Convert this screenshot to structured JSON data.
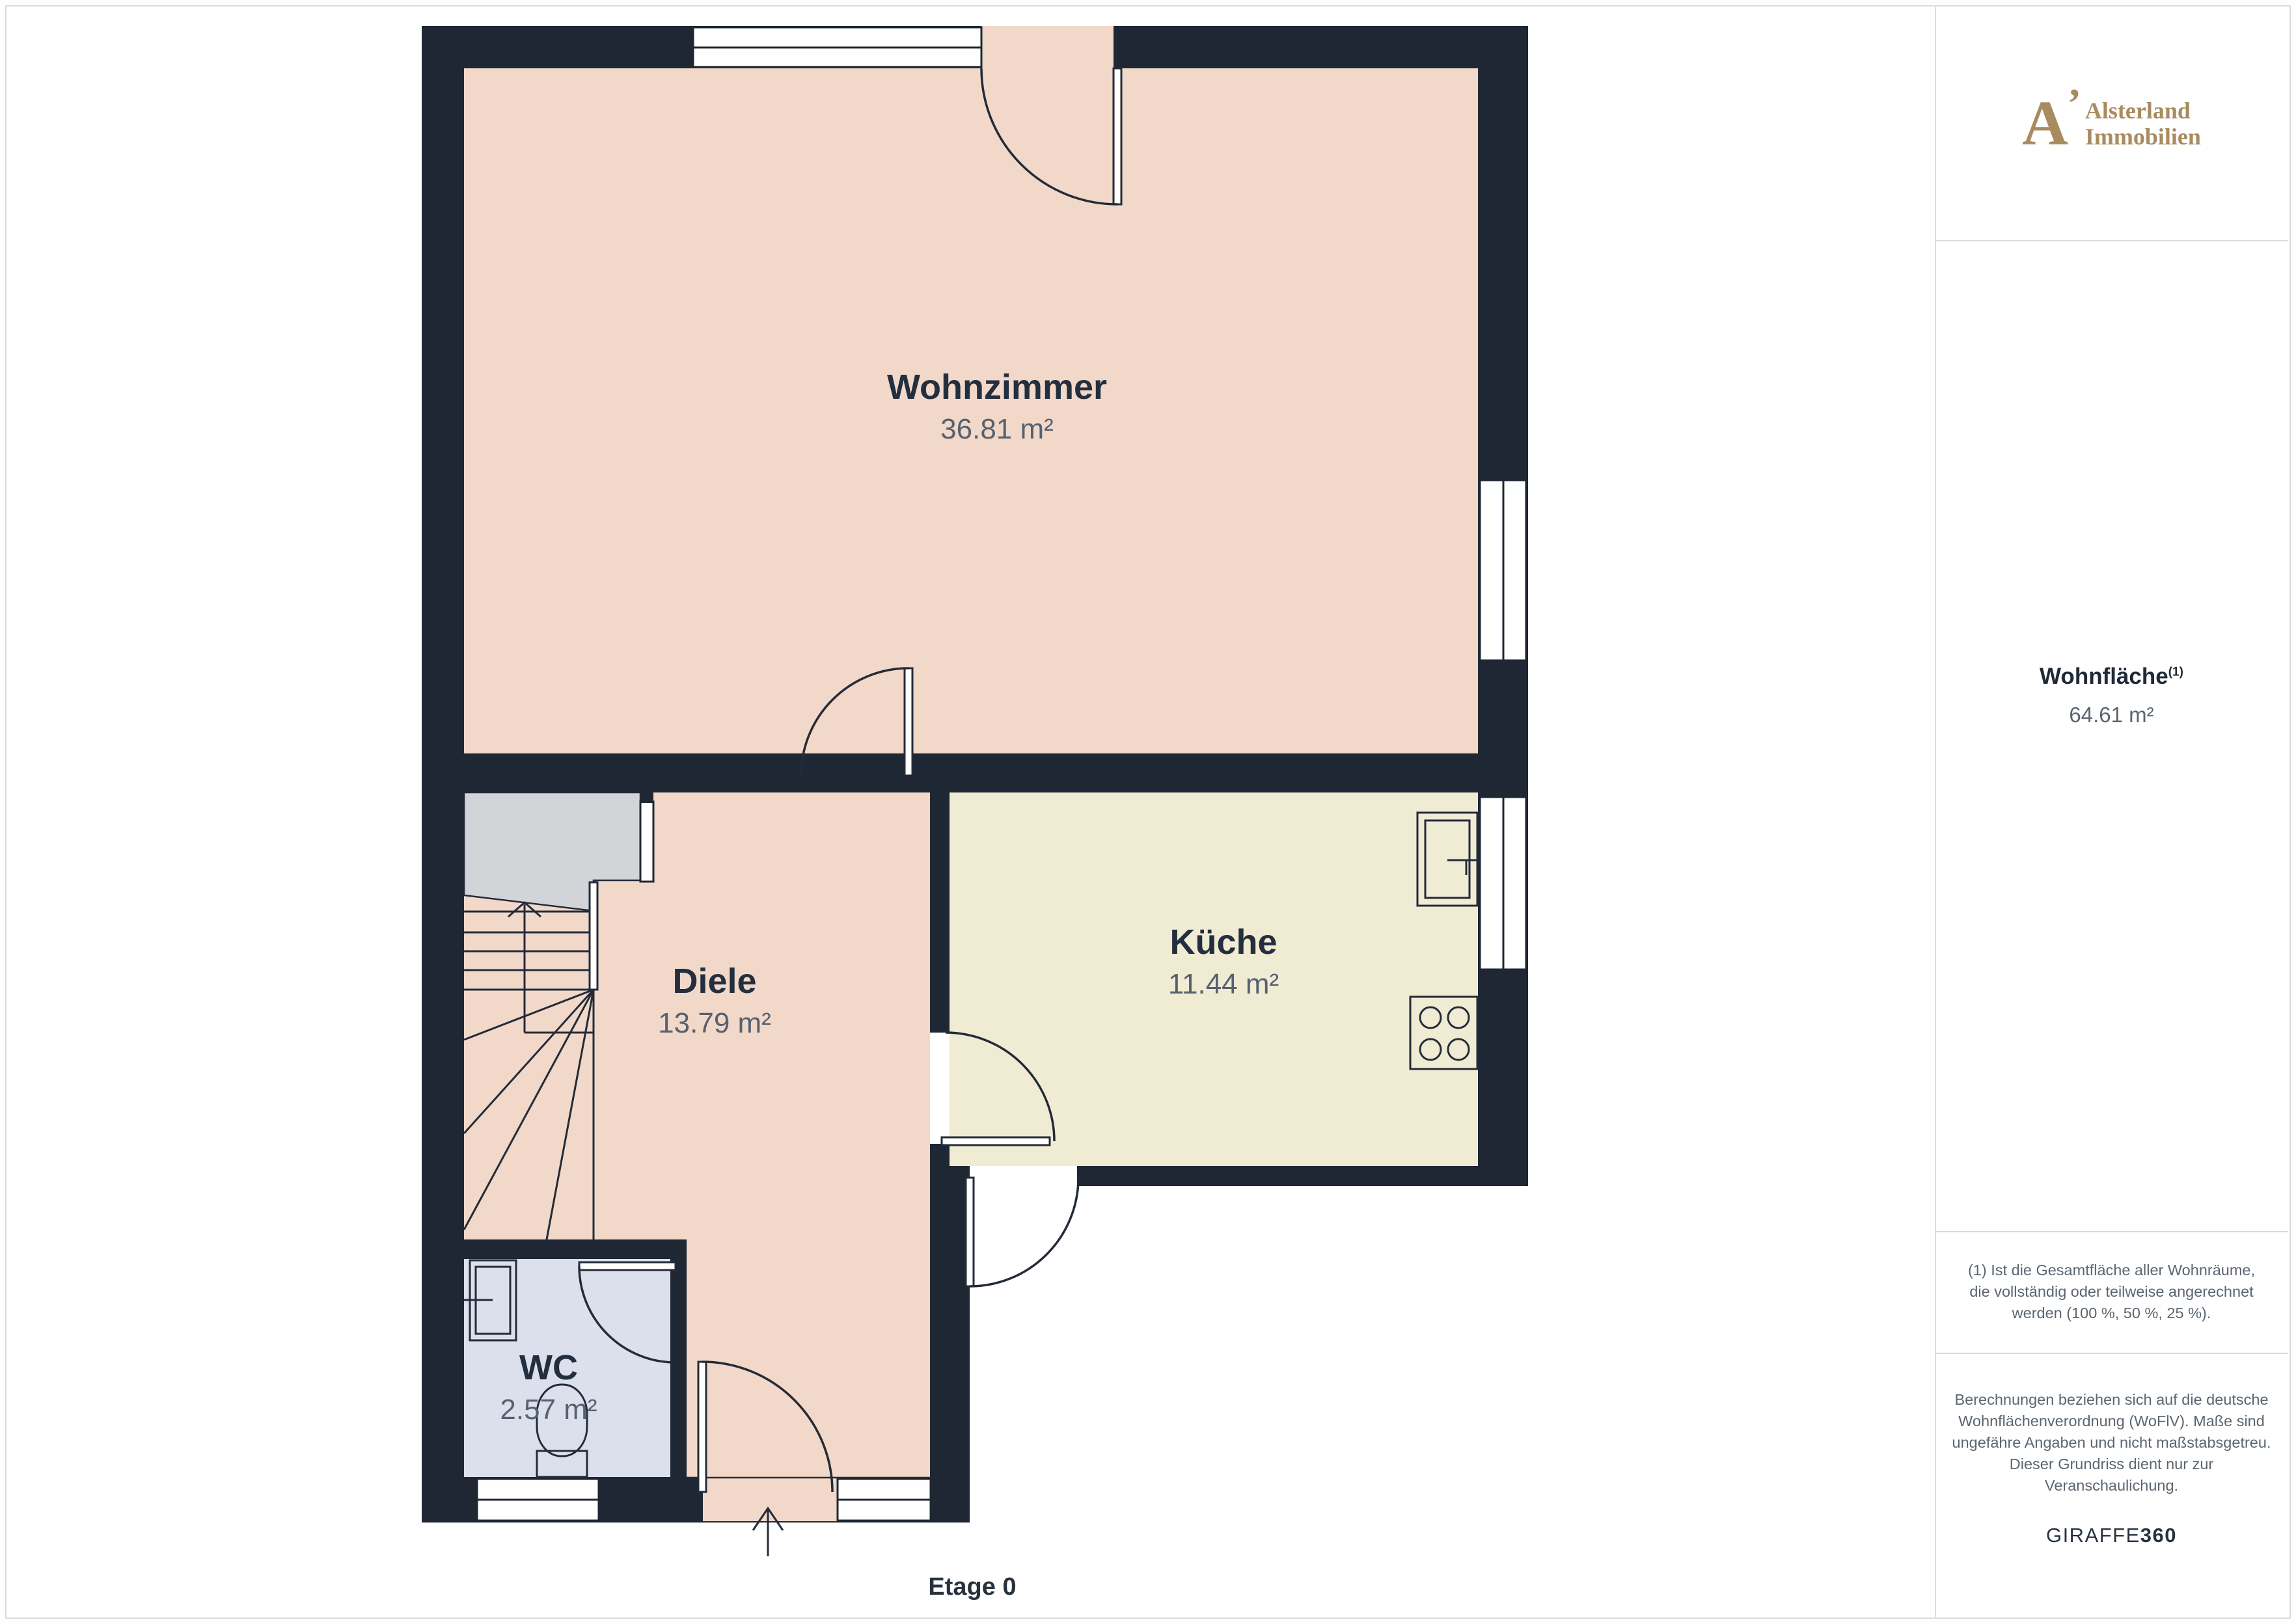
{
  "floorplan": {
    "floor_label": "Etage 0",
    "rooms": [
      {
        "name": "Wohnzimmer",
        "area": "36.81 m²"
      },
      {
        "name": "Küche",
        "area": "11.44 m²"
      },
      {
        "name": "Diele",
        "area": "13.79 m²"
      },
      {
        "name": "WC",
        "area": "2.57 m²"
      }
    ],
    "colors": {
      "wall": "#1e2733",
      "room_pink": "#f2d8c9",
      "kitchen_cream": "#f0ebd3",
      "wc_blue": "#dbe0ec",
      "stair_void_gray": "#d2d4d8",
      "line": "#232b39",
      "room_name_text": "#232e3e",
      "room_area_text": "#566170"
    }
  },
  "sidebar": {
    "brand": {
      "monogram": "A",
      "flourish": "’",
      "line1": "Alsterland",
      "line2": "Immobilien",
      "accent": "#a98b60"
    },
    "total_area": {
      "label": "Wohnfläche",
      "sup": "(1)",
      "value": "64.61 m²"
    },
    "footnote": "(1) Ist die Gesamtfläche aller Wohnräume, die vollständig oder teilweise angerechnet werden (100 %, 50 %, 25 %).",
    "disclaimer": "Berechnungen beziehen sich auf die deutsche Wohnflächenverordnung (WoFlV). Maße sind ungefähre Angaben und nicht maßstabsgetreu. Dieser Grundriss dient nur zur Veranschaulichung.",
    "generator": {
      "normal": "GIRAFFE",
      "bold": "360"
    }
  }
}
